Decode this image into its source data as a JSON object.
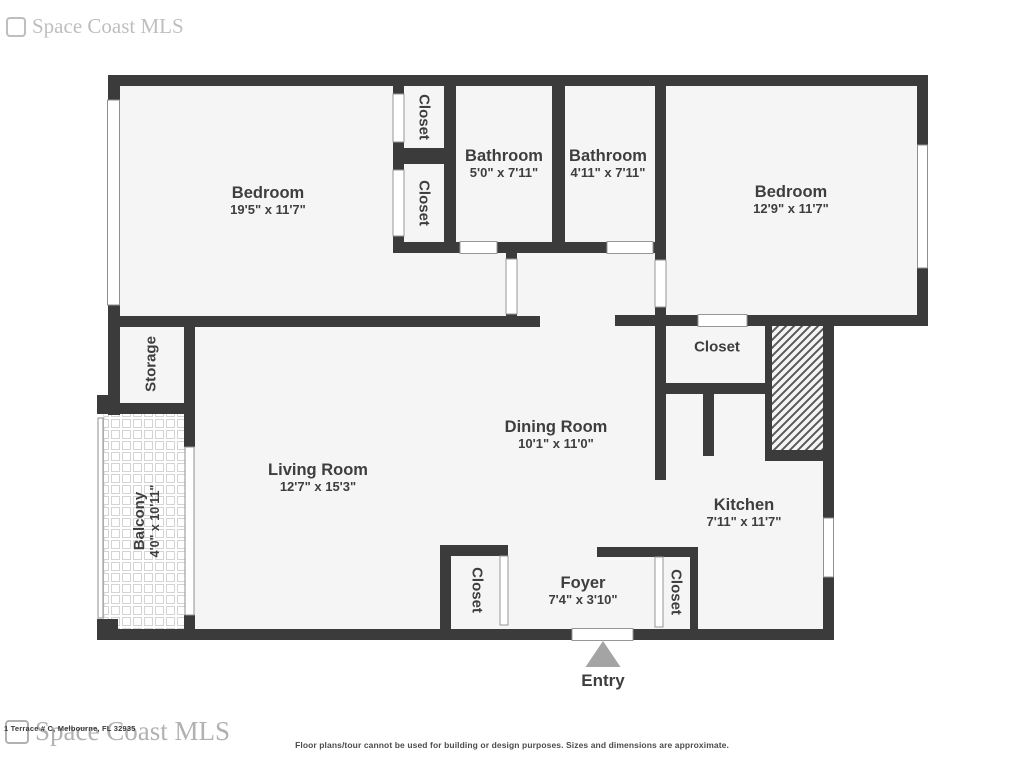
{
  "watermark": {
    "text": "Space Coast MLS"
  },
  "footer": {
    "address": "1 Terrace # C, Melbourne, FL 32935",
    "disclaimer": "Floor plans/tour cannot be used for building or design purposes. Sizes and dimensions are approximate."
  },
  "floorplan": {
    "entry_label": "Entry",
    "rooms": [
      {
        "id": "bedroom-left",
        "name": "Bedroom",
        "dims": "19'5\" x 11'7\""
      },
      {
        "id": "closet-top-1",
        "name": "Closet"
      },
      {
        "id": "closet-top-2",
        "name": "Closet"
      },
      {
        "id": "bathroom-1",
        "name": "Bathroom",
        "dims": "5'0\" x 7'11\""
      },
      {
        "id": "bathroom-2",
        "name": "Bathroom",
        "dims": "4'11\" x 7'11\""
      },
      {
        "id": "bedroom-right",
        "name": "Bedroom",
        "dims": "12'9\" x 11'7\""
      },
      {
        "id": "storage",
        "name": "Storage"
      },
      {
        "id": "balcony",
        "name": "Balcony",
        "dims": "4'0\" x 10'11\""
      },
      {
        "id": "living-room",
        "name": "Living Room",
        "dims": "12'7\" x 15'3\""
      },
      {
        "id": "dining-room",
        "name": "Dining Room",
        "dims": "10'1\" x 11'0\""
      },
      {
        "id": "closet-dining",
        "name": "Closet"
      },
      {
        "id": "kitchen",
        "name": "Kitchen",
        "dims": "7'11\" x 11'7\""
      },
      {
        "id": "closet-foyer-left",
        "name": "Closet"
      },
      {
        "id": "foyer",
        "name": "Foyer",
        "dims": "7'4\" x 3'10\""
      },
      {
        "id": "closet-foyer-right",
        "name": "Closet"
      }
    ],
    "colors": {
      "wall": "#3b3b3b",
      "floor": "#f5f5f5",
      "entry_arrow": "#a4a4a4",
      "label_text": "#3e3e3e"
    }
  }
}
